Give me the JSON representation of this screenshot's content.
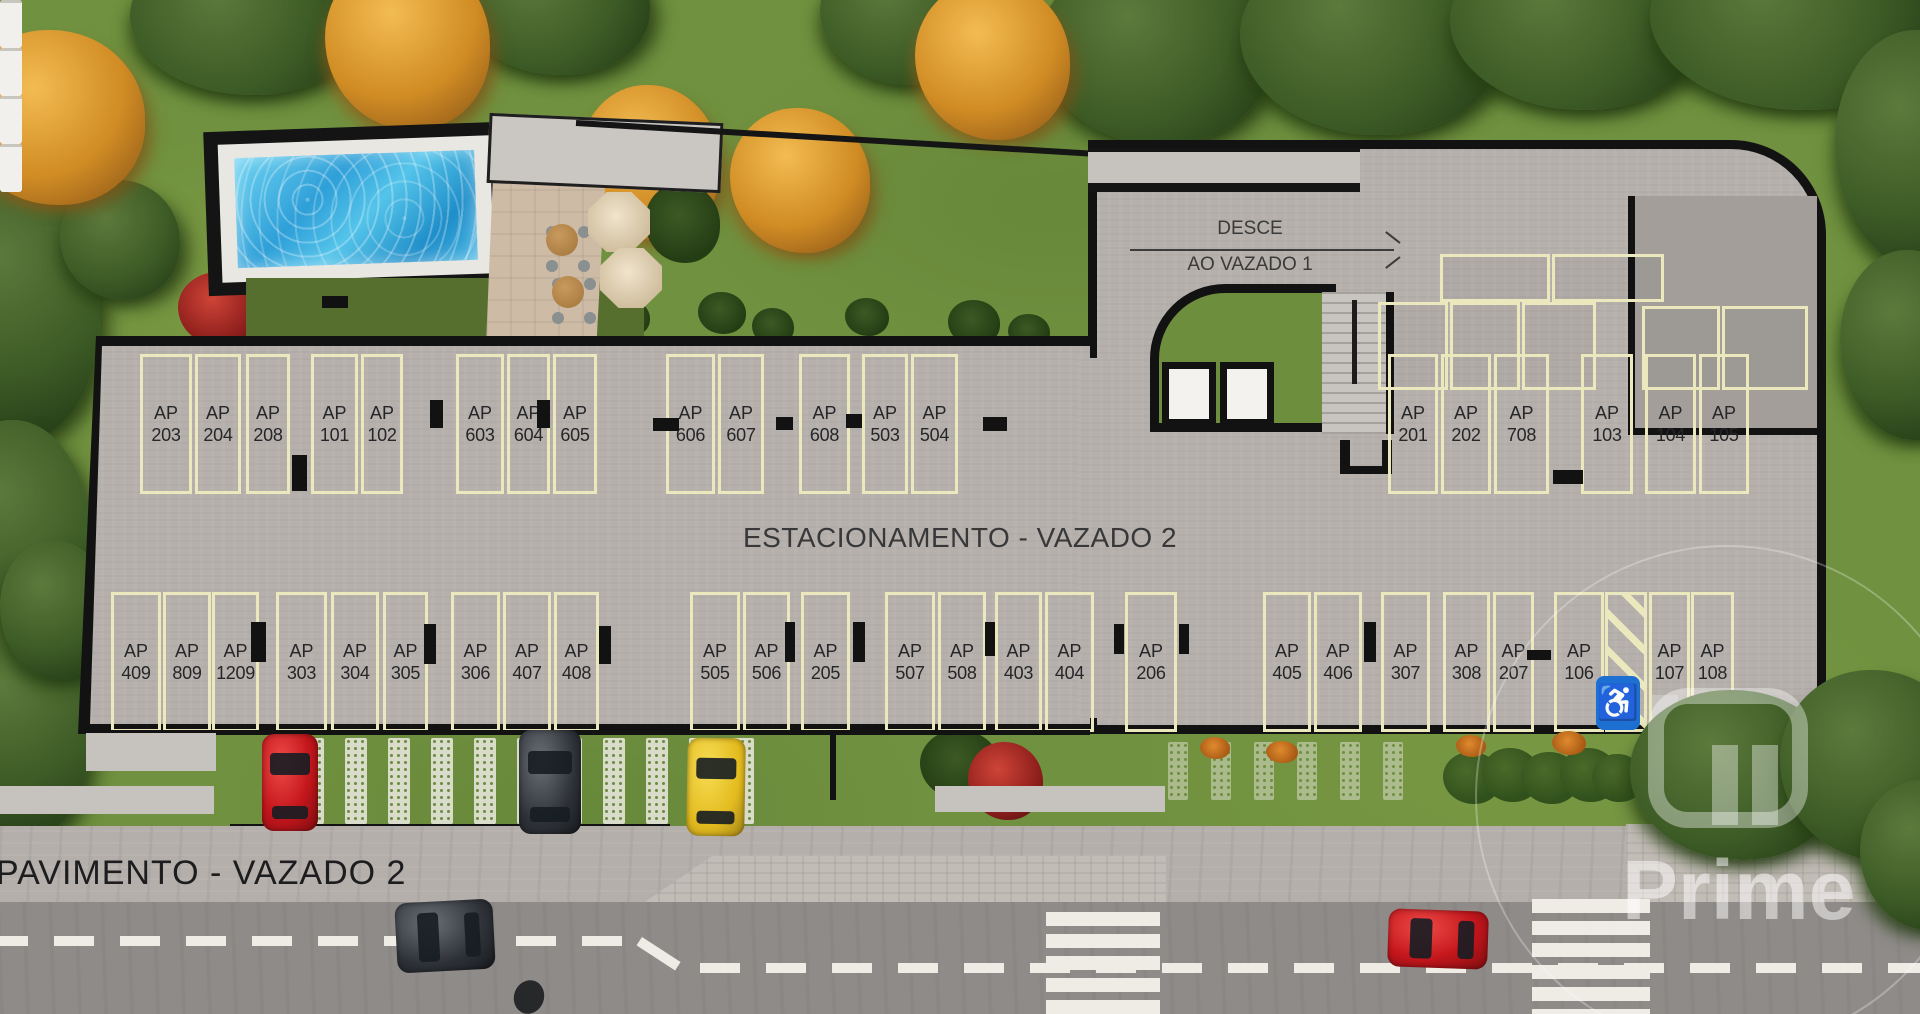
{
  "plan": {
    "center_label": "ESTACIONAMENTO - VAZADO 2",
    "floor_label": "PAVIMENTO - VAZADO 2",
    "ramp": {
      "line1": "DESCE",
      "line2": "AO VAZADO 1"
    },
    "watermark": "Prime",
    "accessible_icon": "♿",
    "accessible_space": "AP 106"
  },
  "colors": {
    "grass": "#70913f",
    "slab": "#b5b0ab",
    "stall_line": "#ece8bd",
    "pool": "#3fb3e4",
    "accessible_blue": "#1e6fd2",
    "road": "#8f8b89",
    "wall_black": "#121212"
  },
  "stalls": {
    "top_row": [
      {
        "label": "AP 203",
        "x": 140,
        "w": 52
      },
      {
        "label": "AP 204",
        "x": 195,
        "w": 46
      },
      {
        "label": "AP 208",
        "x": 246,
        "w": 44
      },
      {
        "label": "AP 101",
        "x": 311,
        "w": 47
      },
      {
        "label": "AP 102",
        "x": 361,
        "w": 42
      },
      {
        "label": "AP 603",
        "x": 456,
        "w": 48
      },
      {
        "label": "AP 604",
        "x": 507,
        "w": 43
      },
      {
        "label": "AP 605",
        "x": 553,
        "w": 44
      },
      {
        "label": "AP 606",
        "x": 666,
        "w": 49
      },
      {
        "label": "AP 607",
        "x": 718,
        "w": 46
      },
      {
        "label": "AP 608",
        "x": 799,
        "w": 51
      },
      {
        "label": "AP 503",
        "x": 862,
        "w": 46
      },
      {
        "label": "AP 504",
        "x": 911,
        "w": 47
      },
      {
        "label": "AP 201",
        "x": 1388,
        "w": 50
      },
      {
        "label": "AP 202",
        "x": 1441,
        "w": 50
      },
      {
        "label": "AP 708",
        "x": 1494,
        "w": 55
      },
      {
        "label": "AP 103",
        "x": 1581,
        "w": 52
      },
      {
        "label": "AP 104",
        "x": 1645,
        "w": 51
      },
      {
        "label": "AP 105",
        "x": 1699,
        "w": 50
      }
    ],
    "bottom_row": [
      {
        "label": "AP 409",
        "x": 111,
        "w": 50
      },
      {
        "label": "AP 809",
        "x": 163,
        "w": 48
      },
      {
        "label": "AP 1209",
        "x": 212,
        "w": 47
      },
      {
        "label": "AP 303",
        "x": 276,
        "w": 51
      },
      {
        "label": "AP 304",
        "x": 331,
        "w": 48
      },
      {
        "label": "AP 305",
        "x": 383,
        "w": 45
      },
      {
        "label": "AP 306",
        "x": 451,
        "w": 49
      },
      {
        "label": "AP 407",
        "x": 503,
        "w": 48
      },
      {
        "label": "AP 408",
        "x": 554,
        "w": 45
      },
      {
        "label": "AP 505",
        "x": 690,
        "w": 50
      },
      {
        "label": "AP 506",
        "x": 743,
        "w": 47
      },
      {
        "label": "AP 205",
        "x": 801,
        "w": 49
      },
      {
        "label": "AP 507",
        "x": 885,
        "w": 50
      },
      {
        "label": "AP 508",
        "x": 938,
        "w": 48
      },
      {
        "label": "AP 403",
        "x": 995,
        "w": 47
      },
      {
        "label": "AP 404",
        "x": 1045,
        "w": 49
      },
      {
        "label": "AP 206",
        "x": 1125,
        "w": 52
      },
      {
        "label": "AP 405",
        "x": 1263,
        "w": 48
      },
      {
        "label": "AP 406",
        "x": 1314,
        "w": 48
      },
      {
        "label": "AP 307",
        "x": 1381,
        "w": 49
      },
      {
        "label": "AP 308",
        "x": 1443,
        "w": 47
      },
      {
        "label": "AP 207",
        "x": 1493,
        "w": 41
      },
      {
        "label": "AP 106",
        "x": 1554,
        "w": 50,
        "accessible": true
      },
      {
        "label": "AP 107",
        "x": 1649,
        "w": 41
      },
      {
        "label": "AP 108",
        "x": 1691,
        "w": 43
      }
    ]
  }
}
